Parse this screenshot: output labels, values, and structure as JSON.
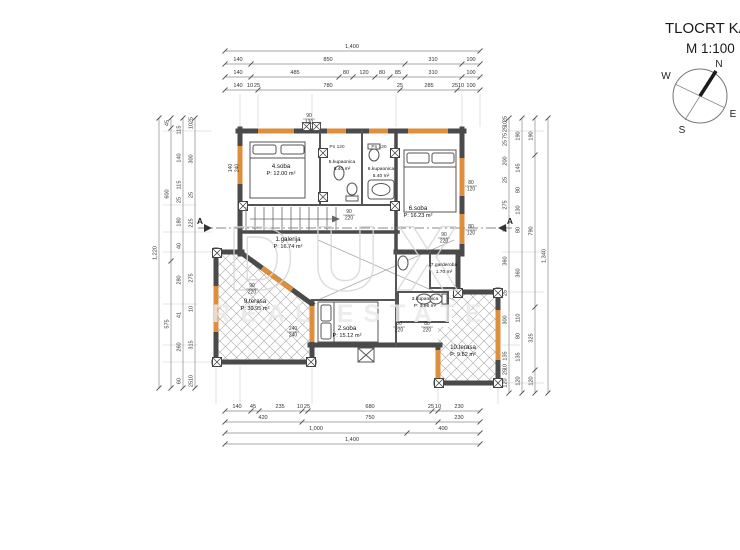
{
  "header": {
    "title": "TLOCRT KATA",
    "scale": "M 1:100"
  },
  "compass": {
    "n": "N",
    "e": "E",
    "s": "S",
    "w": "W"
  },
  "watermark": {
    "primary": "DUX",
    "secondary": "REAL ESTATE"
  },
  "dim_chains": {
    "top": [
      {
        "y": 48,
        "items": [
          {
            "t": "1,400",
            "x": 352
          }
        ]
      },
      {
        "y": 61,
        "items": [
          {
            "t": "140",
            "x": 238
          },
          {
            "t": "850",
            "x": 328
          },
          {
            "t": "310",
            "x": 433
          },
          {
            "t": "100",
            "x": 471
          }
        ]
      },
      {
        "y": 74,
        "items": [
          {
            "t": "140",
            "x": 238
          },
          {
            "t": "485",
            "x": 295
          },
          {
            "t": "80",
            "x": 346
          },
          {
            "t": "120",
            "x": 364
          },
          {
            "t": "80",
            "x": 382
          },
          {
            "t": "85",
            "x": 398
          },
          {
            "t": "310",
            "x": 433
          },
          {
            "t": "100",
            "x": 471
          }
        ]
      },
      {
        "y": 87,
        "items": [
          {
            "t": "140",
            "x": 238
          },
          {
            "t": "10",
            "x": 250
          },
          {
            "t": "25",
            "x": 257
          },
          {
            "t": "780",
            "x": 328
          },
          {
            "t": "25",
            "x": 400
          },
          {
            "t": "285",
            "x": 429
          },
          {
            "t": "25",
            "x": 455
          },
          {
            "t": "10",
            "x": 461
          },
          {
            "t": "100",
            "x": 471
          }
        ]
      }
    ],
    "bottom": [
      {
        "y": 408,
        "items": [
          {
            "t": "140",
            "x": 237
          },
          {
            "t": "45",
            "x": 253
          },
          {
            "t": "235",
            "x": 280
          },
          {
            "t": "10",
            "x": 300
          },
          {
            "t": "25",
            "x": 307
          },
          {
            "t": "680",
            "x": 370
          },
          {
            "t": "25",
            "x": 431
          },
          {
            "t": "10",
            "x": 438
          },
          {
            "t": "230",
            "x": 459
          }
        ]
      },
      {
        "y": 419,
        "items": [
          {
            "t": "420",
            "x": 263
          },
          {
            "t": "750",
            "x": 370
          },
          {
            "t": "230",
            "x": 459
          }
        ]
      },
      {
        "y": 430,
        "items": [
          {
            "t": "1,000",
            "x": 316
          },
          {
            "t": "400",
            "x": 443
          }
        ]
      },
      {
        "y": 441,
        "items": [
          {
            "t": "1,400",
            "x": 352
          }
        ]
      }
    ],
    "left": [
      {
        "x": 159,
        "items": [
          {
            "t": "1,220",
            "y": 253
          }
        ]
      },
      {
        "x": 171,
        "items": [
          {
            "t": "45",
            "y": 123
          },
          {
            "t": "600",
            "y": 194
          },
          {
            "t": "575",
            "y": 324
          }
        ]
      },
      {
        "x": 183,
        "items": [
          {
            "t": "115",
            "y": 130
          },
          {
            "t": "140",
            "y": 158
          },
          {
            "t": "115",
            "y": 185
          },
          {
            "t": "25",
            "y": 200
          },
          {
            "t": "180",
            "y": 222
          },
          {
            "t": "40",
            "y": 246
          },
          {
            "t": "280",
            "y": 280
          },
          {
            "t": "41",
            "y": 315
          },
          {
            "t": "260",
            "y": 347
          },
          {
            "t": "60",
            "y": 381
          }
        ]
      },
      {
        "x": 195,
        "items": [
          {
            "t": "25",
            "y": 120
          },
          {
            "t": "10",
            "y": 126
          },
          {
            "t": "300",
            "y": 159
          },
          {
            "t": "25",
            "y": 195
          },
          {
            "t": "225",
            "y": 223
          },
          {
            "t": "275",
            "y": 278
          },
          {
            "t": "10",
            "y": 309
          },
          {
            "t": "315",
            "y": 345
          },
          {
            "t": "10",
            "y": 378
          },
          {
            "t": "25",
            "y": 384
          }
        ]
      }
    ],
    "right": [
      {
        "x": 509,
        "items": [
          {
            "t": "25",
            "y": 119
          },
          {
            "t": "10",
            "y": 124
          },
          {
            "t": "25",
            "y": 129
          },
          {
            "t": "75",
            "y": 136
          },
          {
            "t": "25",
            "y": 143
          },
          {
            "t": "200",
            "y": 161
          },
          {
            "t": "25",
            "y": 180
          },
          {
            "t": "275",
            "y": 205
          },
          {
            "t": "25",
            "y": 229
          },
          {
            "t": "360",
            "y": 261
          },
          {
            "t": "25",
            "y": 293
          },
          {
            "t": "300",
            "y": 320
          },
          {
            "t": "135",
            "y": 356
          },
          {
            "t": "10",
            "y": 367
          },
          {
            "t": "25",
            "y": 372
          },
          {
            "t": "120",
            "y": 383
          }
        ]
      },
      {
        "x": 522,
        "items": [
          {
            "t": "190",
            "y": 136
          },
          {
            "t": "145",
            "y": 168
          },
          {
            "t": "80",
            "y": 190
          },
          {
            "t": "130",
            "y": 210
          },
          {
            "t": "80",
            "y": 230
          },
          {
            "t": "360",
            "y": 273
          },
          {
            "t": "110",
            "y": 318
          },
          {
            "t": "80",
            "y": 336
          },
          {
            "t": "135",
            "y": 357
          },
          {
            "t": "120",
            "y": 381
          }
        ]
      },
      {
        "x": 535,
        "items": [
          {
            "t": "190",
            "y": 136
          },
          {
            "t": "790",
            "y": 231
          },
          {
            "t": "325",
            "y": 338
          },
          {
            "t": "120",
            "y": 381
          }
        ]
      },
      {
        "x": 548,
        "items": [
          {
            "t": "1,340",
            "y": 256
          }
        ]
      }
    ]
  },
  "rooms": [
    {
      "name": "4.soba",
      "area": "P: 12.00 m²",
      "x": 281,
      "y": 168
    },
    {
      "name": "5.kupaonica",
      "area": "5.40 m²",
      "x": 342,
      "y": 163,
      "small": true
    },
    {
      "name": "6.kupaonica",
      "area": "5.40 m²",
      "x": 381,
      "y": 170,
      "small": true
    },
    {
      "name": "6.soba",
      "area": "P: 16.23 m²",
      "x": 418,
      "y": 210
    },
    {
      "name": "1.galerija",
      "area": "P: 16.74 m²",
      "x": 288,
      "y": 241
    },
    {
      "name": "2.soba",
      "area": "P: 15.12 m²",
      "x": 347,
      "y": 330
    },
    {
      "name": "3.kupaonica",
      "area": "P: 3.96 m²",
      "x": 425,
      "y": 300,
      "small": true
    },
    {
      "name": "7.garderoba",
      "area": "1.70 m²",
      "x": 444,
      "y": 266,
      "small": true
    },
    {
      "name": "9.terasa",
      "area": "P: 30.95 m²",
      "x": 255,
      "y": 303
    },
    {
      "name": "10.terasa",
      "area": "P: 9.82 m²",
      "x": 463,
      "y": 349
    }
  ],
  "door_tags": [
    {
      "a": "90",
      "b": "220",
      "x": 349,
      "y": 213
    },
    {
      "a": "90",
      "b": "220",
      "x": 444,
      "y": 236
    },
    {
      "a": "80",
      "b": "220",
      "x": 399,
      "y": 325
    },
    {
      "a": "80",
      "b": "220",
      "x": 427,
      "y": 325
    },
    {
      "a": "240",
      "b": "240",
      "x": 293,
      "y": 330
    },
    {
      "a": "80",
      "b": "120",
      "x": 471,
      "y": 184
    },
    {
      "a": "80",
      "b": "120",
      "x": 471,
      "y": 228
    },
    {
      "a": "90",
      "b": "220",
      "x": 252,
      "y": 287
    },
    {
      "a": "140",
      "b": "240",
      "x": 232,
      "y": 168,
      "rot": true
    },
    {
      "a": "90",
      "b": "120",
      "x": 309,
      "y": 117
    }
  ],
  "annotations": [
    {
      "t": "Pn 120",
      "x": 337,
      "y": 148
    },
    {
      "t": "Pn 120",
      "x": 379,
      "y": 148
    },
    {
      "t": "A",
      "x": 200,
      "y": 224,
      "cls": "ann-a"
    },
    {
      "t": "A",
      "x": 510,
      "y": 224,
      "cls": "ann-a"
    }
  ]
}
